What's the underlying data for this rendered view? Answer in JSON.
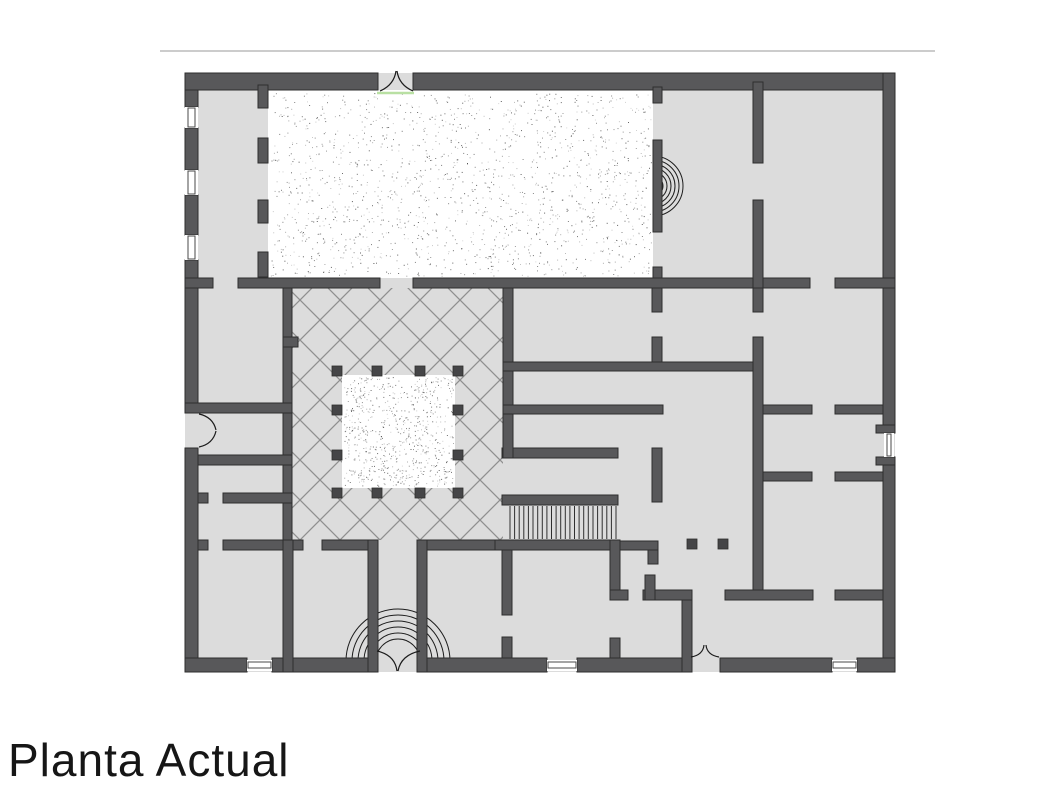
{
  "page": {
    "width": 1060,
    "height": 795,
    "background": "#ffffff"
  },
  "title": {
    "text": "Planta Actual"
  },
  "header_rule": {
    "x": 160,
    "y": 50,
    "length": 775,
    "color": "#cccccc"
  },
  "colors": {
    "wall": "#58585a",
    "wall_stroke": "#2e2e2e",
    "floor": "#dcdcdc",
    "hatch": "#8f8f8f",
    "stipple_dot": "#3c3c3c",
    "arc": "#1c1c1c",
    "threshold_green": "#b9e0a3",
    "column": "#454547",
    "window_frame": "#4a4a4a",
    "tread": "#2f2f2f",
    "white": "#ffffff"
  },
  "plan": {
    "floor": {
      "x": 185,
      "y": 73,
      "w": 710,
      "h": 599
    },
    "stipple_hall": {
      "x": 268,
      "y": 90,
      "w": 385,
      "h": 188,
      "dot_area": {
        "x": 270,
        "y": 93,
        "w": 381,
        "h": 183,
        "count": 1600
      }
    },
    "courtyard_hatch": {
      "x": 292,
      "y": 288,
      "w": 211,
      "h": 252,
      "spacing": 40
    },
    "inner_court": {
      "x": 342,
      "y": 375,
      "w": 113,
      "h": 113,
      "dot_area": {
        "x": 344,
        "y": 377,
        "w": 109,
        "h": 109,
        "count": 700
      }
    },
    "columns": {
      "size": 10,
      "positions": [
        {
          "x": 332,
          "y": 366
        },
        {
          "x": 372,
          "y": 366
        },
        {
          "x": 415,
          "y": 366
        },
        {
          "x": 453,
          "y": 366
        },
        {
          "x": 332,
          "y": 405
        },
        {
          "x": 453,
          "y": 405
        },
        {
          "x": 332,
          "y": 450
        },
        {
          "x": 453,
          "y": 450
        },
        {
          "x": 332,
          "y": 488
        },
        {
          "x": 372,
          "y": 488
        },
        {
          "x": 415,
          "y": 488
        },
        {
          "x": 453,
          "y": 488
        },
        {
          "x": 687,
          "y": 539
        },
        {
          "x": 718,
          "y": 539
        }
      ]
    },
    "walls": [
      {
        "x": 185,
        "y": 73,
        "w": 13,
        "h": 34
      },
      {
        "x": 185,
        "y": 128,
        "w": 13,
        "h": 42
      },
      {
        "x": 185,
        "y": 195,
        "w": 13,
        "h": 40
      },
      {
        "x": 185,
        "y": 260,
        "w": 13,
        "h": 153
      },
      {
        "x": 185,
        "y": 448,
        "w": 13,
        "h": 224
      },
      {
        "x": 185,
        "y": 73,
        "w": 193,
        "h": 17
      },
      {
        "x": 413,
        "y": 73,
        "w": 482,
        "h": 17
      },
      {
        "x": 883,
        "y": 73,
        "w": 12,
        "h": 352
      },
      {
        "x": 883,
        "y": 465,
        "w": 12,
        "h": 207
      },
      {
        "x": 876,
        "y": 425,
        "w": 19,
        "h": 8
      },
      {
        "x": 876,
        "y": 457,
        "w": 19,
        "h": 8
      },
      {
        "x": 185,
        "y": 658,
        "w": 62,
        "h": 14
      },
      {
        "x": 272,
        "y": 658,
        "w": 96,
        "h": 14
      },
      {
        "x": 427,
        "y": 658,
        "w": 120,
        "h": 14
      },
      {
        "x": 577,
        "y": 658,
        "w": 113,
        "h": 14
      },
      {
        "x": 720,
        "y": 658,
        "w": 112,
        "h": 14
      },
      {
        "x": 857,
        "y": 658,
        "w": 38,
        "h": 14
      },
      {
        "x": 258,
        "y": 85,
        "w": 10,
        "h": 23
      },
      {
        "x": 258,
        "y": 138,
        "w": 10,
        "h": 25
      },
      {
        "x": 258,
        "y": 200,
        "w": 10,
        "h": 23
      },
      {
        "x": 258,
        "y": 252,
        "w": 10,
        "h": 25
      },
      {
        "x": 653,
        "y": 87,
        "w": 9,
        "h": 16
      },
      {
        "x": 653,
        "y": 140,
        "w": 9,
        "h": 92
      },
      {
        "x": 653,
        "y": 267,
        "w": 9,
        "h": 21
      },
      {
        "x": 185,
        "y": 278,
        "w": 28,
        "h": 10
      },
      {
        "x": 238,
        "y": 278,
        "w": 142,
        "h": 10
      },
      {
        "x": 413,
        "y": 278,
        "w": 397,
        "h": 10
      },
      {
        "x": 835,
        "y": 278,
        "w": 60,
        "h": 10
      },
      {
        "x": 283,
        "y": 288,
        "w": 9,
        "h": 252
      },
      {
        "x": 283,
        "y": 337,
        "w": 15,
        "h": 10
      },
      {
        "x": 185,
        "y": 403,
        "w": 107,
        "h": 10
      },
      {
        "x": 198,
        "y": 455,
        "w": 94,
        "h": 10
      },
      {
        "x": 198,
        "y": 493,
        "w": 10,
        "h": 10
      },
      {
        "x": 223,
        "y": 493,
        "w": 69,
        "h": 10
      },
      {
        "x": 198,
        "y": 540,
        "w": 10,
        "h": 10
      },
      {
        "x": 223,
        "y": 540,
        "w": 80,
        "h": 10
      },
      {
        "x": 322,
        "y": 540,
        "w": 50,
        "h": 10
      },
      {
        "x": 417,
        "y": 540,
        "w": 85,
        "h": 10
      },
      {
        "x": 368,
        "y": 540,
        "w": 10,
        "h": 132
      },
      {
        "x": 417,
        "y": 540,
        "w": 10,
        "h": 132
      },
      {
        "x": 283,
        "y": 540,
        "w": 10,
        "h": 132
      },
      {
        "x": 502,
        "y": 540,
        "w": 10,
        "h": 75
      },
      {
        "x": 502,
        "y": 637,
        "w": 10,
        "h": 21
      },
      {
        "x": 502,
        "y": 448,
        "w": 116,
        "h": 10
      },
      {
        "x": 652,
        "y": 448,
        "w": 10,
        "h": 54
      },
      {
        "x": 502,
        "y": 495,
        "w": 116,
        "h": 10
      },
      {
        "x": 495,
        "y": 540,
        "w": 123,
        "h": 10
      },
      {
        "x": 618,
        "y": 541,
        "w": 40,
        "h": 9
      },
      {
        "x": 648,
        "y": 550,
        "w": 10,
        "h": 14
      },
      {
        "x": 610,
        "y": 540,
        "w": 10,
        "h": 50
      },
      {
        "x": 610,
        "y": 590,
        "w": 18,
        "h": 10
      },
      {
        "x": 610,
        "y": 638,
        "w": 10,
        "h": 20
      },
      {
        "x": 503,
        "y": 288,
        "w": 10,
        "h": 170
      },
      {
        "x": 503,
        "y": 362,
        "w": 260,
        "h": 9
      },
      {
        "x": 503,
        "y": 405,
        "w": 160,
        "h": 9
      },
      {
        "x": 652,
        "y": 288,
        "w": 10,
        "h": 24
      },
      {
        "x": 652,
        "y": 337,
        "w": 10,
        "h": 25
      },
      {
        "x": 753,
        "y": 82,
        "w": 10,
        "h": 81
      },
      {
        "x": 753,
        "y": 200,
        "w": 10,
        "h": 88
      },
      {
        "x": 753,
        "y": 288,
        "w": 10,
        "h": 24
      },
      {
        "x": 753,
        "y": 337,
        "w": 10,
        "h": 263
      },
      {
        "x": 763,
        "y": 405,
        "w": 49,
        "h": 9
      },
      {
        "x": 835,
        "y": 405,
        "w": 48,
        "h": 9
      },
      {
        "x": 763,
        "y": 472,
        "w": 49,
        "h": 9
      },
      {
        "x": 835,
        "y": 472,
        "w": 48,
        "h": 9
      },
      {
        "x": 725,
        "y": 590,
        "w": 88,
        "h": 10
      },
      {
        "x": 835,
        "y": 590,
        "w": 48,
        "h": 10
      },
      {
        "x": 682,
        "y": 600,
        "w": 10,
        "h": 72
      },
      {
        "x": 643,
        "y": 590,
        "w": 49,
        "h": 10
      },
      {
        "x": 645,
        "y": 575,
        "w": 10,
        "h": 25
      }
    ],
    "windows": [
      {
        "x": 185,
        "y": 107,
        "w": 13,
        "h": 21,
        "orientation": "v"
      },
      {
        "x": 185,
        "y": 170,
        "w": 13,
        "h": 25,
        "orientation": "v"
      },
      {
        "x": 185,
        "y": 235,
        "w": 13,
        "h": 25,
        "orientation": "v"
      },
      {
        "x": 884,
        "y": 433,
        "w": 10,
        "h": 24,
        "orientation": "v"
      },
      {
        "x": 247,
        "y": 660,
        "w": 25,
        "h": 11,
        "orientation": "h"
      },
      {
        "x": 547,
        "y": 660,
        "w": 30,
        "h": 11,
        "orientation": "h"
      },
      {
        "x": 832,
        "y": 660,
        "w": 25,
        "h": 11,
        "orientation": "h"
      }
    ],
    "stairs": {
      "x1": 510,
      "x2": 616,
      "y1": 506,
      "y2": 539,
      "treads": 23
    },
    "niche_arcs": {
      "cx": 653,
      "cy": 186,
      "radii": [
        10,
        14,
        18,
        22,
        26,
        30
      ],
      "opening": "left"
    },
    "entrance_fan": {
      "cx": 398,
      "cy": 661,
      "radii": [
        22,
        28,
        34,
        40,
        46,
        52
      ],
      "opening": "down"
    },
    "door_swings": [
      {
        "name": "top-entrance-doors",
        "path": "M380,91 Q394,85 396,71 M413,91 Q399,85 397,71"
      },
      {
        "name": "main-entrance-doors",
        "path": "M377,651 Q395,655 397,671 M420,651 Q401,655 398,671"
      },
      {
        "name": "left-door",
        "path": "M199,414 Q213,417 216,430 M199,447 Q213,444 216,431"
      },
      {
        "name": "south-small-door",
        "path": "M691,657 Q703,655 704,645 M719,657 Q707,655 706,645"
      }
    ],
    "threshold": {
      "x1": 377,
      "y1": 93,
      "x2": 414,
      "y2": 93
    }
  }
}
